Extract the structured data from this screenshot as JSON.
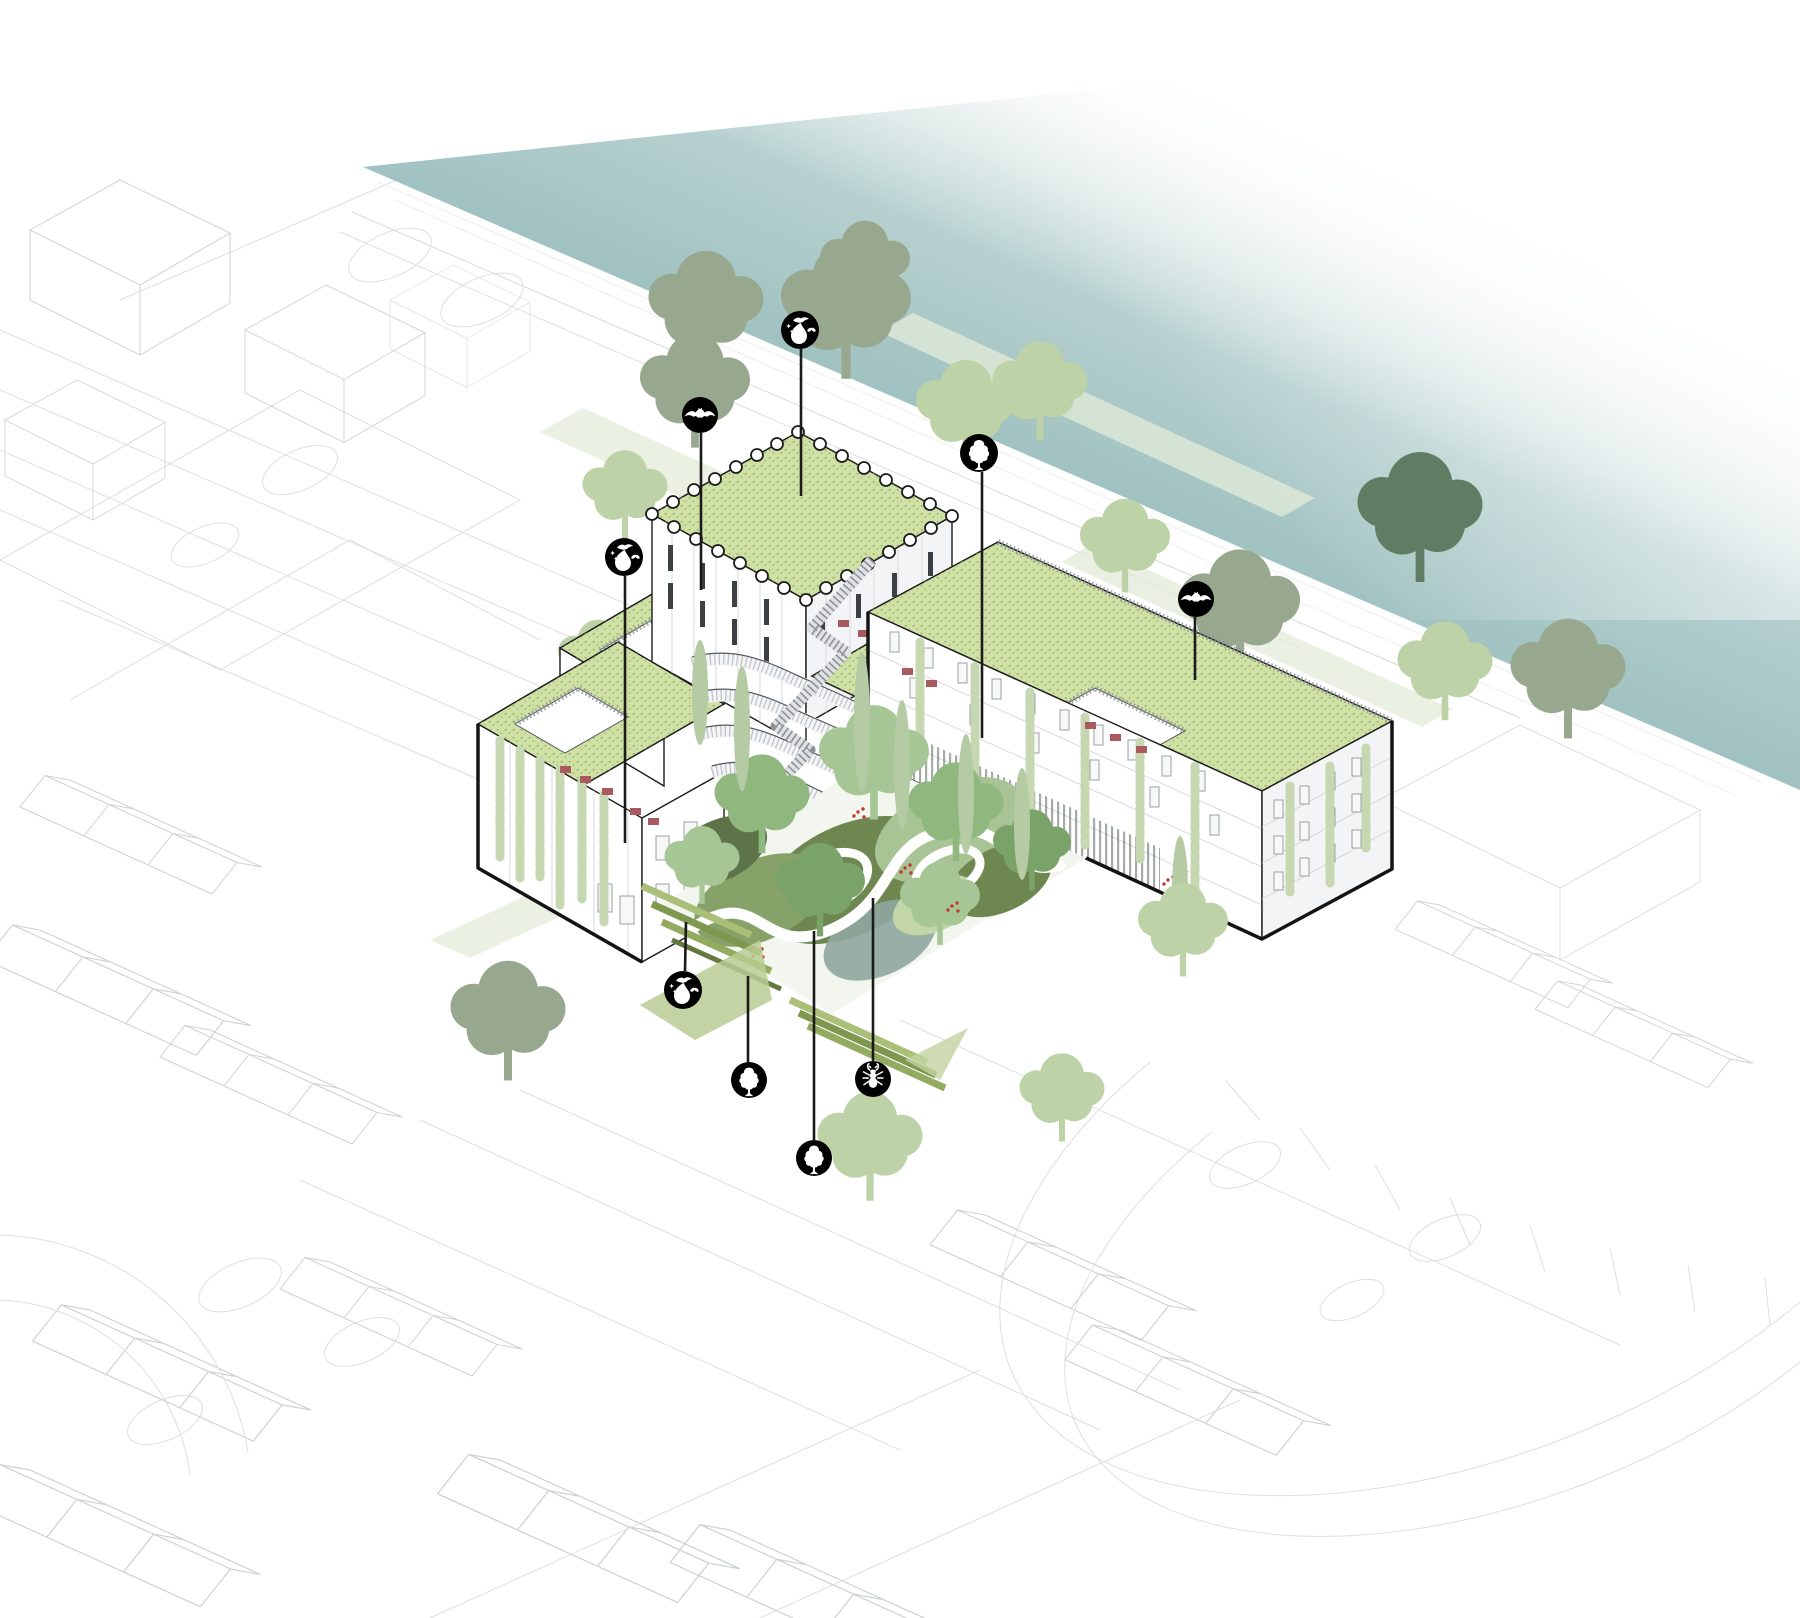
{
  "meta": {
    "kind": "architectural axonometric biodiversity diagram",
    "visible_text": "none"
  },
  "palette": {
    "water_teal": "#9dc0bf",
    "water_teal_deep": "#8cb4b4",
    "green_roof": "#cfe0a5",
    "green_roof_stipple": "#94ad66",
    "canopy_sage": "#97a88f",
    "canopy_pale": "#bdd2a6",
    "canopy_dark": "#5f7d62",
    "garden_olive": "#6e8751",
    "garden_mid": "#87a268",
    "garden_light": "#a8c394",
    "garden_gray_green": "#8fa69e",
    "garden_dark": "#5c7448",
    "garden_pale": "#c2d6a8",
    "cypress_green": "#b4cba4",
    "vine_green": "#c6d7b2",
    "accent_red": "#a85a5e",
    "flower_red": "#c23b2e",
    "icon_bg": "#000000",
    "icon_fg": "#ffffff",
    "leader_line": "#1a1a1a"
  },
  "annotations": {
    "icons": [
      {
        "name": "bird-habitat-icon",
        "glyph": "bird-bush-butterfly",
        "x": 800,
        "y": 330,
        "r": 19,
        "line": [
          801,
          349,
          801,
          496
        ]
      },
      {
        "name": "bat-habitat-icon",
        "glyph": "bat",
        "x": 700,
        "y": 415,
        "r": 18,
        "line": [
          701,
          433,
          701,
          590
        ]
      },
      {
        "name": "roof-tree-icon",
        "glyph": "tree",
        "x": 979,
        "y": 453,
        "r": 19,
        "line": [
          982,
          472,
          982,
          738
        ]
      },
      {
        "name": "terrace-bird-habitat-icon",
        "glyph": "bird-bush-butterfly",
        "x": 624,
        "y": 557,
        "r": 19,
        "line": [
          625,
          576,
          625,
          843
        ]
      },
      {
        "name": "street-bat-habitat-icon",
        "glyph": "bat",
        "x": 1196,
        "y": 599,
        "r": 18,
        "line": [
          1195,
          617,
          1195,
          680
        ]
      },
      {
        "name": "garden-bird-habitat-icon",
        "glyph": "bird-bush-butterfly",
        "x": 683,
        "y": 990,
        "r": 19,
        "line": [
          686,
          922,
          685,
          971
        ]
      },
      {
        "name": "garden-tree-icon",
        "glyph": "tree",
        "x": 749,
        "y": 1080,
        "r": 18,
        "line": [
          748,
          976,
          748,
          1062
        ]
      },
      {
        "name": "insect-habitat-icon",
        "glyph": "stag-beetle",
        "x": 873,
        "y": 1079,
        "r": 18,
        "line": [
          873,
          898,
          873,
          1061
        ]
      },
      {
        "name": "small-tree-icon",
        "glyph": "tree",
        "x": 814,
        "y": 1158,
        "r": 18,
        "line": [
          814,
          931,
          814,
          1140
        ]
      }
    ]
  },
  "scene": {
    "street_trees": [
      {
        "x": 706,
        "y": 352,
        "s": 1.15,
        "tone": "sage"
      },
      {
        "x": 846,
        "y": 358,
        "s": 1.3,
        "tone": "sage"
      },
      {
        "x": 695,
        "y": 430,
        "s": 1.1,
        "tone": "sage"
      },
      {
        "x": 865,
        "y": 300,
        "s": 0.9,
        "tone": "sage"
      },
      {
        "x": 625,
        "y": 525,
        "s": 0.85,
        "tone": "pale"
      },
      {
        "x": 598,
        "y": 690,
        "s": 0.8,
        "tone": "pale"
      },
      {
        "x": 966,
        "y": 448,
        "s": 1.0,
        "tone": "pale"
      },
      {
        "x": 1040,
        "y": 425,
        "s": 0.95,
        "tone": "pale"
      },
      {
        "x": 1125,
        "y": 578,
        "s": 0.9,
        "tone": "pale"
      },
      {
        "x": 1240,
        "y": 655,
        "s": 1.2,
        "tone": "sage"
      },
      {
        "x": 1420,
        "y": 562,
        "s": 1.25,
        "tone": "dark"
      },
      {
        "x": 1445,
        "y": 705,
        "s": 0.95,
        "tone": "pale"
      },
      {
        "x": 1568,
        "y": 720,
        "s": 1.15,
        "tone": "sage"
      }
    ],
    "front_trees": [
      {
        "x": 508,
        "y": 1062,
        "s": 1.15,
        "tone": "sage"
      },
      {
        "x": 870,
        "y": 1184,
        "s": 1.05,
        "tone": "pale"
      },
      {
        "x": 1062,
        "y": 1128,
        "s": 0.85,
        "tone": "pale"
      },
      {
        "x": 1183,
        "y": 962,
        "s": 0.9,
        "tone": "pale"
      }
    ],
    "garden_trees": [
      {
        "x": 762,
        "y": 838,
        "s": 0.95,
        "tone": "g1"
      },
      {
        "x": 874,
        "y": 802,
        "s": 1.1,
        "tone": "g2"
      },
      {
        "x": 956,
        "y": 846,
        "s": 0.95,
        "tone": "g1"
      },
      {
        "x": 820,
        "y": 922,
        "s": 0.9,
        "tone": "g3"
      },
      {
        "x": 940,
        "y": 932,
        "s": 0.8,
        "tone": "g2"
      },
      {
        "x": 1032,
        "y": 878,
        "s": 0.78,
        "tone": "g3"
      },
      {
        "x": 702,
        "y": 892,
        "s": 0.75,
        "tone": "g2"
      }
    ],
    "cypresses": [
      {
        "x": 700,
        "y": 640,
        "h": 105
      },
      {
        "x": 742,
        "y": 666,
        "h": 125
      },
      {
        "x": 862,
        "y": 652,
        "h": 140
      },
      {
        "x": 902,
        "y": 700,
        "h": 130
      },
      {
        "x": 966,
        "y": 734,
        "h": 120
      },
      {
        "x": 1022,
        "y": 768,
        "h": 112
      },
      {
        "x": 1180,
        "y": 836,
        "h": 110
      }
    ],
    "vines": [
      {
        "x": 500,
        "y": 740,
        "h": 120
      },
      {
        "x": 520,
        "y": 750,
        "h": 130
      },
      {
        "x": 540,
        "y": 760,
        "h": 120
      },
      {
        "x": 560,
        "y": 770,
        "h": 135
      },
      {
        "x": 582,
        "y": 782,
        "h": 120
      },
      {
        "x": 604,
        "y": 794,
        "h": 130
      },
      {
        "x": 920,
        "y": 642,
        "h": 118
      },
      {
        "x": 975,
        "y": 666,
        "h": 130
      },
      {
        "x": 1030,
        "y": 692,
        "h": 120
      },
      {
        "x": 1085,
        "y": 717,
        "h": 132
      },
      {
        "x": 1140,
        "y": 742,
        "h": 118
      },
      {
        "x": 1195,
        "y": 766,
        "h": 126
      },
      {
        "x": 1290,
        "y": 786,
        "h": 110
      },
      {
        "x": 1330,
        "y": 766,
        "h": 118
      },
      {
        "x": 1366,
        "y": 748,
        "h": 100
      }
    ],
    "red_accents": [
      [
        560,
        766
      ],
      [
        580,
        776
      ],
      [
        602,
        788
      ],
      [
        630,
        808
      ],
      [
        648,
        818
      ],
      [
        902,
        668
      ],
      [
        926,
        680
      ],
      [
        1085,
        722
      ],
      [
        1110,
        734
      ],
      [
        1136,
        746
      ],
      [
        838,
        620
      ],
      [
        858,
        630
      ]
    ],
    "flower_clusters": [
      [
        858,
        812
      ],
      [
        905,
        868
      ],
      [
        757,
        952
      ],
      [
        952,
        906
      ],
      [
        1168,
        880
      ]
    ]
  }
}
